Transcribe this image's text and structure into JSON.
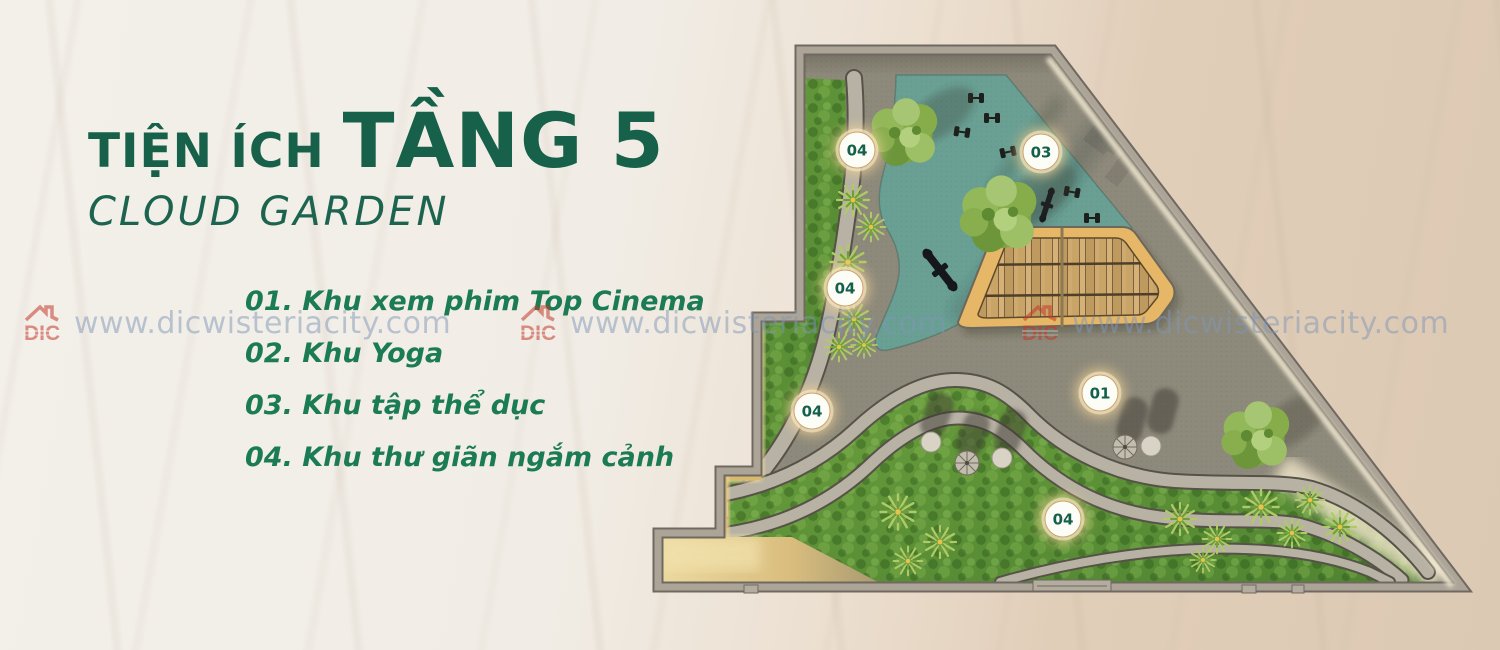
{
  "page": {
    "width": 1500,
    "height": 650,
    "description": "Real-estate brochure page: floor-5 amenity site plan (Cloud Garden)"
  },
  "header": {
    "title_prefix": "TIỆN ÍCH",
    "title_emphasis": "TẦNG 5",
    "subtitle": "CLOUD GARDEN",
    "title_color": "#17604a"
  },
  "legend": {
    "items": [
      "01. Khu xem phim Top Cinema",
      "02. Khu Yoga",
      "03. Khu tập thể dục",
      "04. Khu thư giãn ngắm cảnh"
    ],
    "text_color": "#1b7b55"
  },
  "watermark": {
    "logo_text": "DIC",
    "url": "www.dicwisteriacity.com",
    "instances": [
      {
        "x": 22
      },
      {
        "x": 518
      },
      {
        "x": 1020
      }
    ],
    "text_color": "rgba(125,150,182,0.5)",
    "logo_color": "#c33a28"
  },
  "plan": {
    "name": "Cloud Garden floor-5 site plan",
    "markers": [
      {
        "label": "04",
        "x": 857,
        "y": 150
      },
      {
        "label": "03",
        "x": 1041,
        "y": 152
      },
      {
        "label": "04",
        "x": 845,
        "y": 288
      },
      {
        "label": "01",
        "x": 1100,
        "y": 393
      },
      {
        "label": "04",
        "x": 812,
        "y": 411
      },
      {
        "label": "04",
        "x": 1063,
        "y": 519
      }
    ],
    "zone_colors": {
      "plaza": "#8e8a7b",
      "fitness_teal": "#6aa094",
      "deck_border": "#e5b766",
      "deck_planks": "#c9a467",
      "hedge_green": "#5f9338",
      "gold_light": "#e7cf96",
      "wall_gray": "#aca597"
    }
  }
}
